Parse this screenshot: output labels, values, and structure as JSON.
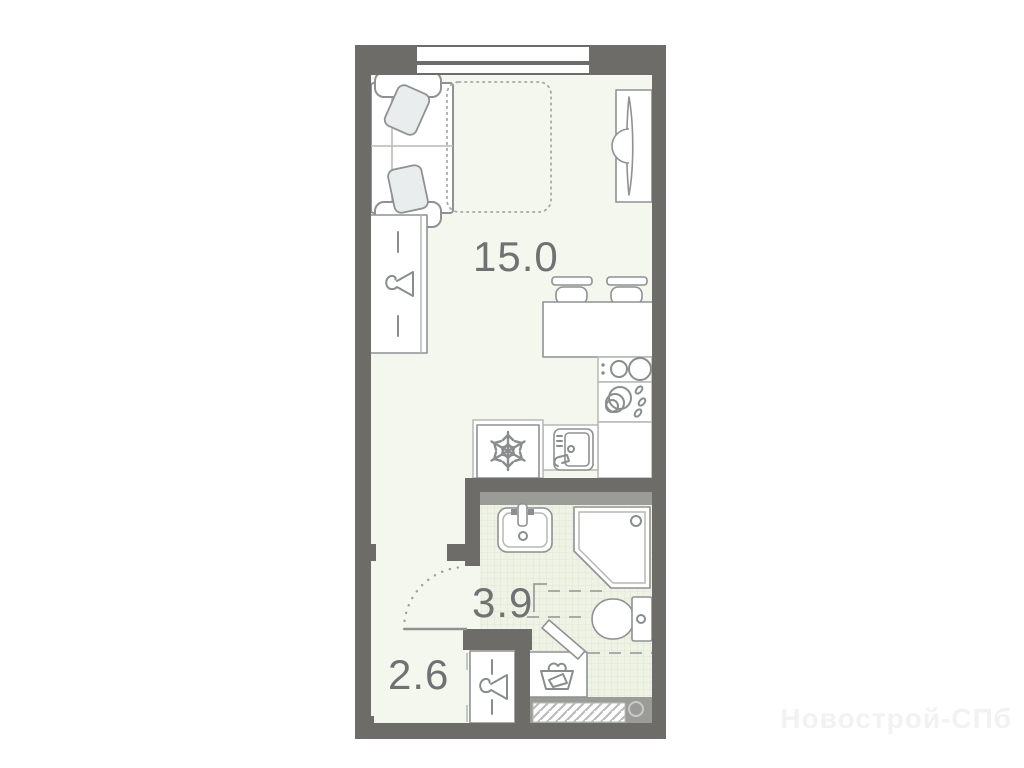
{
  "floorplan": {
    "title": "studio-apartment-floorplan",
    "rooms": [
      {
        "name": "living-room-kitchen",
        "area": "15.0"
      },
      {
        "name": "bathroom",
        "area": "3.9"
      },
      {
        "name": "hallway",
        "area": "2.6"
      }
    ],
    "colors": {
      "wall": "#6e6c69",
      "wall_light": "#9b9b98",
      "floor": "#f3f7ee",
      "tile": "#eef3e6",
      "tile_grid": "#dde7d1",
      "outline": "#8f9192",
      "label": "#6f7173",
      "watermark": "#f2f2f2"
    },
    "fixtures": [
      "window",
      "sofa",
      "bed",
      "tv-unit",
      "wardrobe",
      "dining-table",
      "bar-stools",
      "stove",
      "dish-rack",
      "kitchen-sink",
      "fridge",
      "washbasin",
      "shower-cabin",
      "toilet",
      "washing-machine",
      "hallway-closet",
      "door-swing",
      "entrance-door"
    ]
  },
  "watermark": {
    "text": "Новострой-СПб"
  }
}
